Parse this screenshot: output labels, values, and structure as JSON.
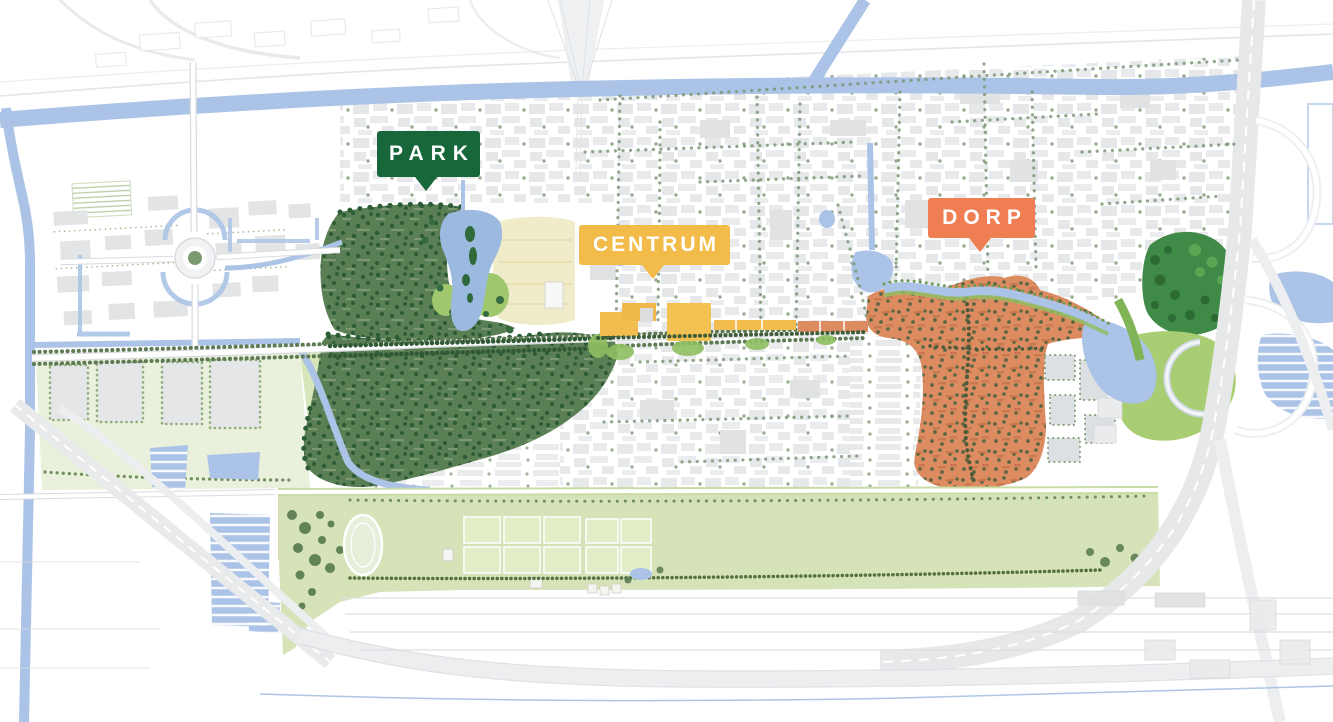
{
  "map": {
    "kind": "urban-masterplan-map",
    "districts": [
      {
        "id": "park",
        "label": "PARK",
        "color": "#17673a",
        "text_color": "#ffffff"
      },
      {
        "id": "centrum",
        "label": "CENTRUM",
        "color": "#f2bb4a",
        "text_color": "#ffffff"
      },
      {
        "id": "dorp",
        "label": "DORP",
        "color": "#ef7e52",
        "text_color": "#ffffff"
      }
    ],
    "palette": {
      "water": "#abc3e6",
      "park_green": "#5b7f55",
      "park_tree": "#2c5c35",
      "lawn_green": "#9fc76d",
      "beige_field": "#f0ecca",
      "dorp_orange": "#dd8b61",
      "sports_green": "#d6e3b8",
      "field_green": "#e2ecc6",
      "forest_green": "#3f8a46",
      "loop_green": "#a9cd72",
      "building_gray": "#e3e4e7",
      "street_tree": "#7d9878"
    }
  }
}
